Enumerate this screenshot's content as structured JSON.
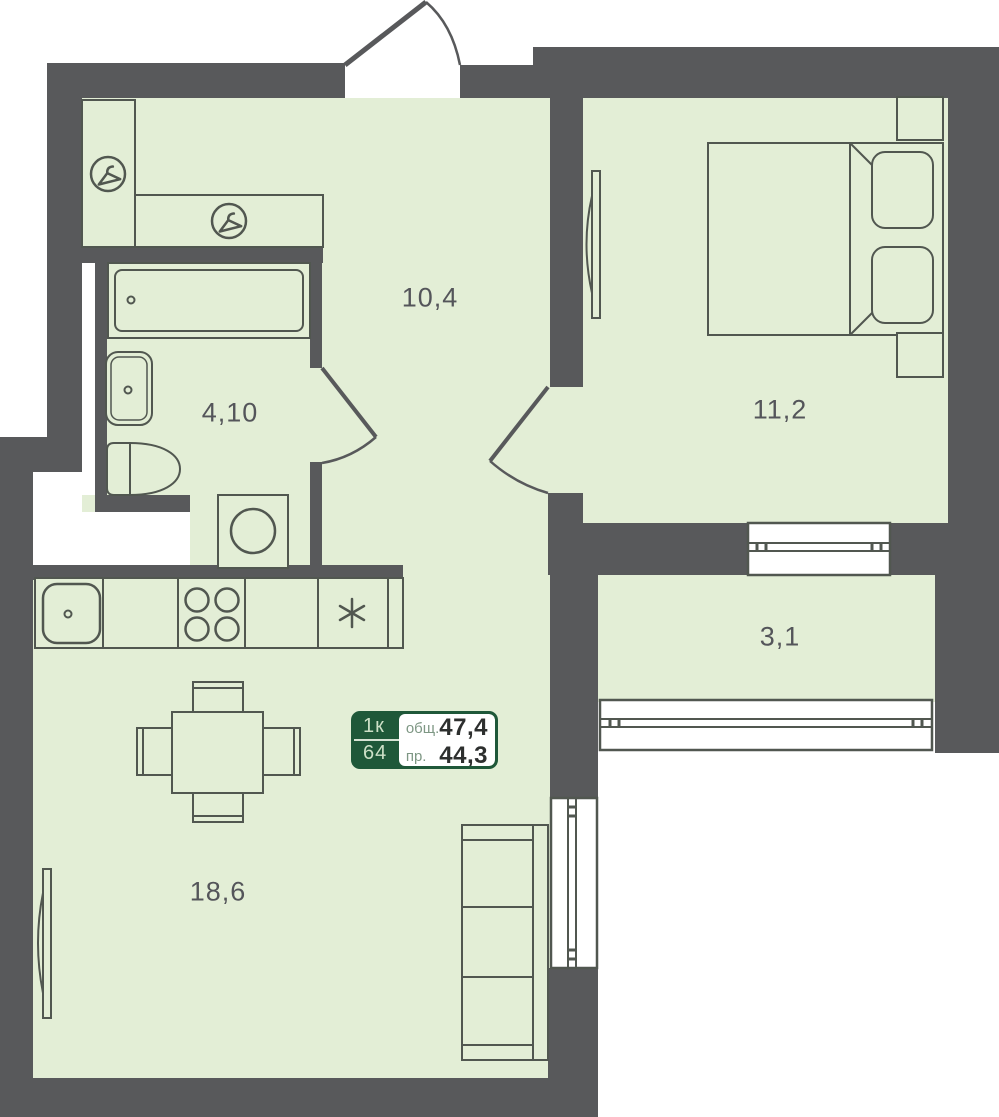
{
  "plan_title": "1-room apartment floor plan",
  "rooms": [
    {
      "name": "hallway",
      "area": "10,4"
    },
    {
      "name": "bathroom",
      "area": "4,10"
    },
    {
      "name": "bedroom",
      "area": "11,2"
    },
    {
      "name": "balcony",
      "area": "3,1"
    },
    {
      "name": "living-kitchen",
      "area": "18,6"
    }
  ],
  "badge": {
    "rooms_count": "1к",
    "unit_number": "64",
    "total_label": "общ.",
    "total_value": "47,4",
    "living_label": "пр.",
    "living_value": "44,3"
  },
  "icons": [
    "hanger-icon",
    "hanger-icon",
    "stove-burners-icon",
    "fridge-snowflake-icon"
  ],
  "colors": {
    "wall": "#58595b",
    "floor": "#e3eed6",
    "outline": "#515750",
    "badge_green": "#1f5839",
    "label_text": "#54555a"
  }
}
